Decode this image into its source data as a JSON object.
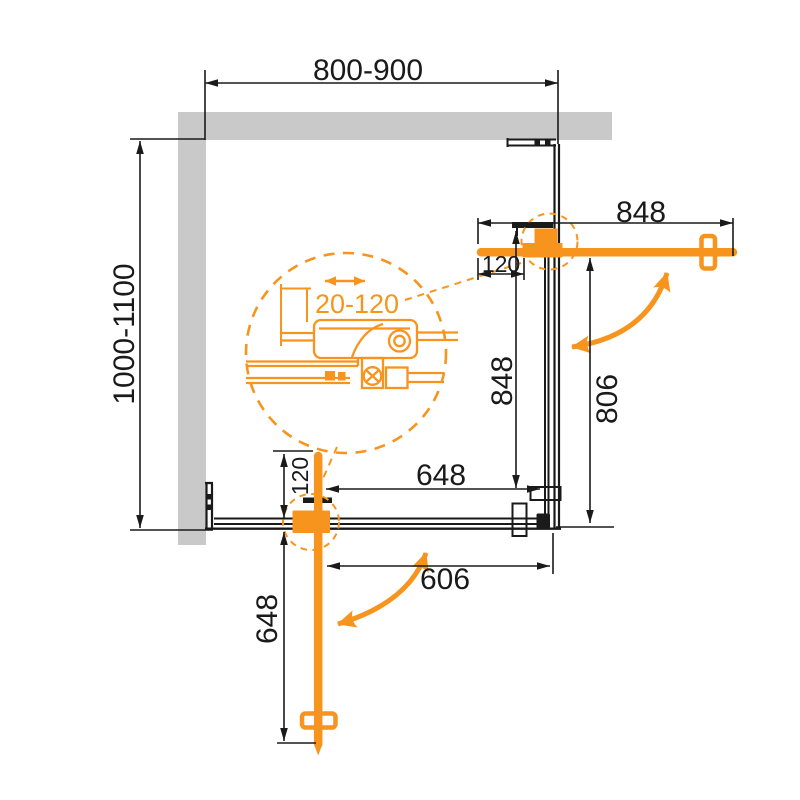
{
  "drawing": {
    "kind": "corner shower enclosure plan view",
    "colors": {
      "accent_orange": "#F7941D",
      "line_black": "#1A1A1A",
      "wall_gray": "#C9C9C9",
      "background": "#FFFFFF"
    },
    "icons": {
      "swing_arrow": "curved-double-headed-arrow",
      "slide_adjust_arrow": "horizontal-double-headed-arrow",
      "detail_circle": "dashed-magnifier-circle"
    }
  },
  "dims": {
    "top_width": "800-900",
    "left_depth": "1000-1100",
    "right_door": "848",
    "right_offset": "120",
    "right_panel": "848",
    "right_opening": "806",
    "bottom_panel": "648",
    "bottom_opening": "606",
    "bottom_offset": "120",
    "bottom_door": "648",
    "adjustment": "20-120"
  }
}
